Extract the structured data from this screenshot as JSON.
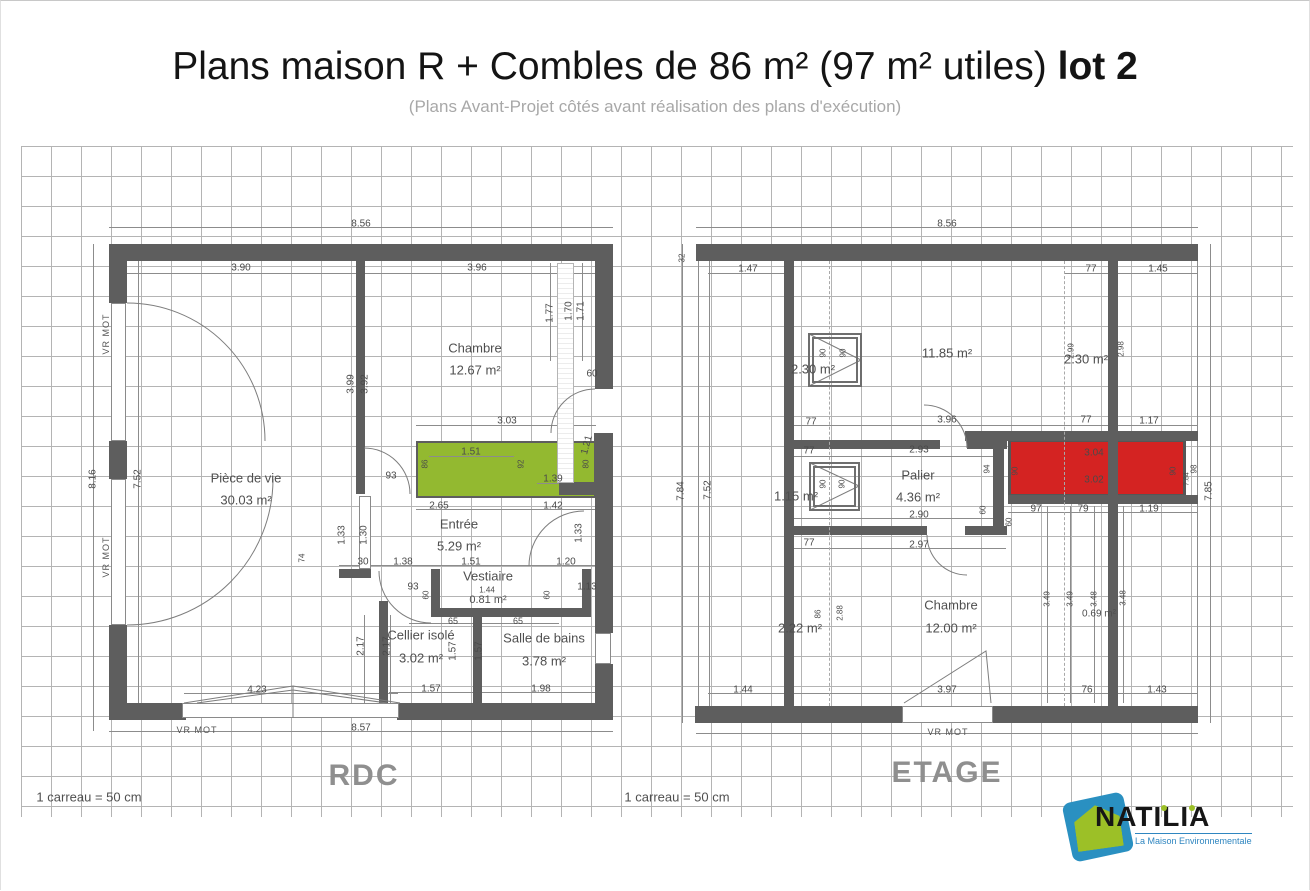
{
  "title": {
    "main": "Plans maison R + Combles de 86 m² (97 m² utiles) ",
    "bold": "lot 2",
    "subtitle": "(Plans Avant-Projet côtés avant réalisation des plans d'exécution)"
  },
  "logo": {
    "name": "NATILIA",
    "tagline": "La Maison Environnementale",
    "brand_blue": "#2a90c1",
    "brand_green": "#9cc027"
  },
  "colors": {
    "wall": "#5e5e5e",
    "grid_line": "#9b9b9b",
    "green_zone": "#93b930",
    "red_zone": "#d42322",
    "dim_text": "#4a4a4a"
  },
  "rdc": {
    "floor_label": "RDC",
    "scale_note": "1 carreau = 50 cm",
    "rooms": [
      {
        "name": "Pièce de vie",
        "area": "30.03 m²"
      },
      {
        "name": "Chambre",
        "area": "12.67 m²"
      },
      {
        "name": "Entrée",
        "area": "5.29 m²"
      },
      {
        "name": "Vestiaire",
        "area": "0.81 m²"
      },
      {
        "name": "Cellier isolé",
        "area": "3.02 m²"
      },
      {
        "name": "Salle de bains",
        "area": "3.78 m²"
      }
    ],
    "labels": [
      {
        "t": "8.56",
        "x": 360,
        "y": 223
      },
      {
        "t": "3.90",
        "x": 240,
        "y": 267
      },
      {
        "t": "3.96",
        "x": 476,
        "y": 267
      },
      {
        "t": "1.77",
        "x": 549,
        "y": 312,
        "r": -90
      },
      {
        "t": "1.70",
        "x": 568,
        "y": 310,
        "r": -90
      },
      {
        "t": "1.71",
        "x": 580,
        "y": 310,
        "r": -90
      },
      {
        "t": "3.99",
        "x": 350,
        "y": 383,
        "r": -90
      },
      {
        "t": "3.92",
        "x": 364,
        "y": 383,
        "r": -90
      },
      {
        "t": "3.03",
        "x": 506,
        "y": 420
      },
      {
        "t": "60",
        "x": 591,
        "y": 373
      },
      {
        "t": "1.21",
        "x": 586,
        "y": 444,
        "r": -75
      },
      {
        "t": "1.51",
        "x": 470,
        "y": 451
      },
      {
        "t": "86",
        "x": 424,
        "y": 463,
        "r": -90,
        "s": 8
      },
      {
        "t": "92",
        "x": 520,
        "y": 463,
        "r": -90,
        "s": 8
      },
      {
        "t": "1.39",
        "x": 552,
        "y": 478
      },
      {
        "t": "80",
        "x": 585,
        "y": 463,
        "r": -90,
        "s": 8
      },
      {
        "t": "93",
        "x": 390,
        "y": 475
      },
      {
        "t": "2.65",
        "x": 438,
        "y": 505
      },
      {
        "t": "1.42",
        "x": 552,
        "y": 505
      },
      {
        "t": "1.33",
        "x": 341,
        "y": 534,
        "r": -90
      },
      {
        "t": "1.30",
        "x": 363,
        "y": 534,
        "r": -90
      },
      {
        "t": "1.33",
        "x": 578,
        "y": 532,
        "r": -90
      },
      {
        "t": "30",
        "x": 362,
        "y": 561
      },
      {
        "t": "1.38",
        "x": 402,
        "y": 561
      },
      {
        "t": "1.51",
        "x": 470,
        "y": 561
      },
      {
        "t": "1.20",
        "x": 565,
        "y": 561
      },
      {
        "t": "74",
        "x": 301,
        "y": 557,
        "r": -90,
        "s": 8
      },
      {
        "t": "93",
        "x": 412,
        "y": 586
      },
      {
        "t": "60",
        "x": 425,
        "y": 594,
        "r": -90,
        "s": 8
      },
      {
        "t": "60",
        "x": 546,
        "y": 594,
        "r": -90,
        "s": 8
      },
      {
        "t": "1.13",
        "x": 586,
        "y": 586
      },
      {
        "t": "1.44",
        "x": 486,
        "y": 589,
        "s": 8
      },
      {
        "t": "65",
        "x": 452,
        "y": 620,
        "s": 9
      },
      {
        "t": "65",
        "x": 517,
        "y": 620,
        "s": 9
      },
      {
        "t": "2.17",
        "x": 360,
        "y": 645,
        "r": -90
      },
      {
        "t": "2.17",
        "x": 386,
        "y": 645,
        "r": -90
      },
      {
        "t": "1.57",
        "x": 452,
        "y": 650,
        "r": -90
      },
      {
        "t": "1.57",
        "x": 478,
        "y": 650,
        "r": -90
      },
      {
        "t": "1.57",
        "x": 430,
        "y": 688
      },
      {
        "t": "1.98",
        "x": 540,
        "y": 688
      },
      {
        "t": "4.23",
        "x": 256,
        "y": 689
      },
      {
        "t": "8.57",
        "x": 360,
        "y": 727
      },
      {
        "t": "8.16",
        "x": 92,
        "y": 478,
        "r": -90
      },
      {
        "t": "7.52",
        "x": 137,
        "y": 478,
        "r": -90
      },
      {
        "t": "VR MOT",
        "x": 105,
        "y": 333,
        "r": -90,
        "c": "vr"
      },
      {
        "t": "VR MOT",
        "x": 105,
        "y": 556,
        "r": -90,
        "c": "vr"
      },
      {
        "t": "VR MOT",
        "x": 196,
        "y": 729,
        "c": "vr"
      },
      {
        "t": "Pièce de vie",
        "x": 245,
        "y": 477,
        "c": "room"
      },
      {
        "t": "30.03 m²",
        "x": 245,
        "y": 499,
        "c": "room"
      },
      {
        "t": "Chambre",
        "x": 474,
        "y": 347,
        "c": "room"
      },
      {
        "t": "12.67 m²",
        "x": 474,
        "y": 369,
        "c": "room"
      },
      {
        "t": "Entrée",
        "x": 458,
        "y": 523,
        "c": "room"
      },
      {
        "t": "5.29 m²",
        "x": 458,
        "y": 545,
        "c": "room"
      },
      {
        "t": "Vestiaire",
        "x": 487,
        "y": 575,
        "c": "room"
      },
      {
        "t": "0.81 m²",
        "x": 487,
        "y": 599,
        "c": "room",
        "s": 11
      },
      {
        "t": "Cellier isolé",
        "x": 420,
        "y": 634,
        "c": "room"
      },
      {
        "t": "3.02 m²",
        "x": 420,
        "y": 657,
        "c": "room"
      },
      {
        "t": "Salle de bains",
        "x": 543,
        "y": 637,
        "c": "room"
      },
      {
        "t": "3.78 m²",
        "x": 543,
        "y": 660,
        "c": "room"
      },
      {
        "t": "RDC",
        "x": 363,
        "y": 775,
        "c": "flr"
      },
      {
        "t": "1 carreau = 50 cm",
        "x": 88,
        "y": 796,
        "c": "scale"
      }
    ]
  },
  "etage": {
    "floor_label": "ETAGE",
    "scale_note": "1 carreau = 50 cm",
    "rooms": [
      {
        "name": "",
        "area": "2.30 m²"
      },
      {
        "name": "",
        "area": "11.85 m²"
      },
      {
        "name": "",
        "area": "2.30 m²"
      },
      {
        "name": "",
        "area": "1.15 m²"
      },
      {
        "name": "Palier",
        "area": "4.36 m²"
      },
      {
        "name": "",
        "area": "2.22 m²"
      },
      {
        "name": "Chambre",
        "area": "12.00 m²"
      },
      {
        "name": "",
        "area": "0.69 m²"
      }
    ],
    "labels": [
      {
        "t": "8.56",
        "x": 946,
        "y": 223
      },
      {
        "t": "32",
        "x": 681,
        "y": 257,
        "r": -90,
        "s": 8
      },
      {
        "t": "1.47",
        "x": 747,
        "y": 268
      },
      {
        "t": "77",
        "x": 1090,
        "y": 268
      },
      {
        "t": "1.45",
        "x": 1157,
        "y": 268
      },
      {
        "t": "2.30 m²",
        "x": 812,
        "y": 368,
        "c": "room"
      },
      {
        "t": "11.85 m²",
        "x": 946,
        "y": 352,
        "c": "room"
      },
      {
        "t": "2.30 m²",
        "x": 1085,
        "y": 358,
        "c": "room"
      },
      {
        "t": "2.99",
        "x": 1070,
        "y": 350,
        "r": -90,
        "s": 8
      },
      {
        "t": "2.98",
        "x": 1120,
        "y": 348,
        "r": -90,
        "s": 8
      },
      {
        "t": "90",
        "x": 822,
        "y": 352,
        "r": -90,
        "s": 8
      },
      {
        "t": "90",
        "x": 842,
        "y": 352,
        "r": -90,
        "s": 8
      },
      {
        "t": "77",
        "x": 810,
        "y": 421
      },
      {
        "t": "3.96",
        "x": 946,
        "y": 419
      },
      {
        "t": "77",
        "x": 1085,
        "y": 419
      },
      {
        "t": "1.17",
        "x": 1148,
        "y": 420
      },
      {
        "t": "77",
        "x": 808,
        "y": 450
      },
      {
        "t": "2.93",
        "x": 918,
        "y": 449
      },
      {
        "t": "94",
        "x": 986,
        "y": 468,
        "r": -90,
        "s": 8
      },
      {
        "t": "Palier",
        "x": 917,
        "y": 474,
        "c": "room"
      },
      {
        "t": "4.36 m²",
        "x": 917,
        "y": 496,
        "c": "room"
      },
      {
        "t": "2.90",
        "x": 918,
        "y": 514
      },
      {
        "t": "60",
        "x": 982,
        "y": 509,
        "r": -90,
        "s": 8
      },
      {
        "t": "60",
        "x": 1008,
        "y": 521,
        "r": -90,
        "s": 8
      },
      {
        "t": "77",
        "x": 808,
        "y": 542
      },
      {
        "t": "2.97",
        "x": 918,
        "y": 544
      },
      {
        "t": "3.04",
        "x": 1093,
        "y": 452
      },
      {
        "t": "3.02",
        "x": 1093,
        "y": 479
      },
      {
        "t": "90",
        "x": 1014,
        "y": 470,
        "r": -90,
        "s": 8
      },
      {
        "t": "90",
        "x": 1172,
        "y": 470,
        "r": -90,
        "s": 8
      },
      {
        "t": "7.84",
        "x": 1186,
        "y": 478,
        "r": -90,
        "s": 7
      },
      {
        "t": "98",
        "x": 1193,
        "y": 468,
        "r": -90,
        "s": 8
      },
      {
        "t": "7.85",
        "x": 1208,
        "y": 490,
        "r": -90
      },
      {
        "t": "97",
        "x": 1035,
        "y": 508
      },
      {
        "t": "79",
        "x": 1082,
        "y": 508
      },
      {
        "t": "1.19",
        "x": 1148,
        "y": 508
      },
      {
        "t": "1.15 m²",
        "x": 795,
        "y": 495,
        "c": "room"
      },
      {
        "t": "90",
        "x": 822,
        "y": 483,
        "r": -90,
        "s": 8
      },
      {
        "t": "90",
        "x": 841,
        "y": 483,
        "r": -90,
        "s": 8
      },
      {
        "t": "7.84",
        "x": 680,
        "y": 490,
        "r": -90
      },
      {
        "t": "7.52",
        "x": 707,
        "y": 489,
        "r": -90
      },
      {
        "t": "2.22 m²",
        "x": 799,
        "y": 627,
        "c": "room"
      },
      {
        "t": "86",
        "x": 817,
        "y": 613,
        "r": -90,
        "s": 8
      },
      {
        "t": "2.88",
        "x": 839,
        "y": 612,
        "r": -90,
        "s": 8
      },
      {
        "t": "Chambre",
        "x": 950,
        "y": 604,
        "c": "room"
      },
      {
        "t": "12.00 m²",
        "x": 950,
        "y": 627,
        "c": "room"
      },
      {
        "t": "3.49",
        "x": 1046,
        "y": 598,
        "r": -90,
        "s": 8
      },
      {
        "t": "3.49",
        "x": 1069,
        "y": 598,
        "r": -90,
        "s": 8
      },
      {
        "t": "3.48",
        "x": 1093,
        "y": 598,
        "r": -90,
        "s": 8
      },
      {
        "t": "0.69 m²",
        "x": 1098,
        "y": 613,
        "c": "room",
        "s": 10
      },
      {
        "t": "3.48",
        "x": 1122,
        "y": 597,
        "r": -90,
        "s": 8
      },
      {
        "t": "1.44",
        "x": 742,
        "y": 689
      },
      {
        "t": "3.97",
        "x": 946,
        "y": 689
      },
      {
        "t": "76",
        "x": 1086,
        "y": 689
      },
      {
        "t": "1.43",
        "x": 1156,
        "y": 689
      },
      {
        "t": "VR MOT",
        "x": 947,
        "y": 731,
        "c": "vr"
      },
      {
        "t": "ETAGE",
        "x": 946,
        "y": 772,
        "c": "flr"
      },
      {
        "t": "1 carreau = 50 cm",
        "x": 676,
        "y": 796,
        "c": "scale"
      }
    ]
  }
}
